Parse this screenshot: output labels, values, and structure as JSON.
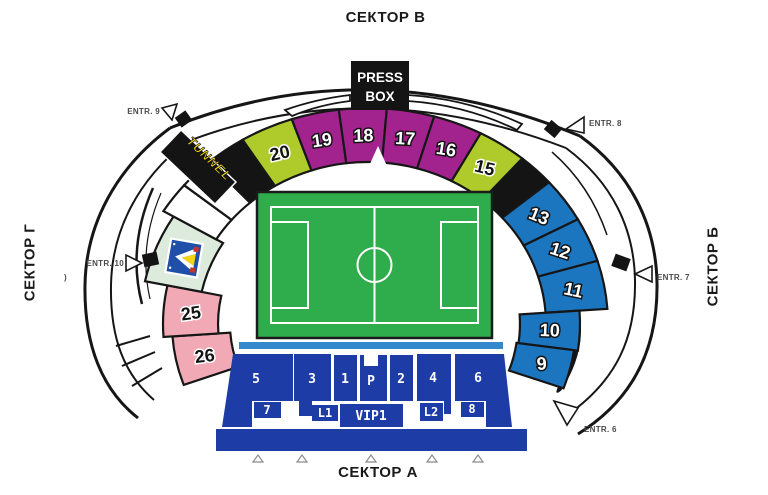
{
  "titles": {
    "top": "СЕКТОР В",
    "bottom": "СЕКТОР А",
    "left": "СЕКТОР Г",
    "right": "СЕКТОР Б"
  },
  "press_box": {
    "line1": "PRESS",
    "line2": "BOX"
  },
  "tunnel": {
    "label": "TUNNEL",
    "text_color": "#F2D516"
  },
  "colors": {
    "magenta": "#A3238E",
    "lime": "#AFCA2B",
    "blue": "#1B76BF",
    "pink": "#F2A9B6",
    "pale_green": "#DCEBDC",
    "black": "#141414",
    "white": "#FFFFFF",
    "dark_blue": "#1E3CA6",
    "light_blue": "#3389CB",
    "field_green": "#2FAC4B",
    "crest_blue": "#1F4FA8",
    "crest_yellow": "#F5D414",
    "crest_red": "#C4332D"
  },
  "arc_sections": [
    {
      "label": "26",
      "color": "pink",
      "a0": 184,
      "a1": 200,
      "radii": [
        138,
        125,
        196,
        178
      ],
      "num": "dark",
      "rot": -7
    },
    {
      "label": "25",
      "color": "pink",
      "a0": 168,
      "a1": 184,
      "radii": [
        150,
        136,
        205,
        186
      ],
      "num": "dark",
      "rot": -8
    },
    {
      "label": "",
      "color": "pale_green",
      "a0": 148.5,
      "a1": 168,
      "radii": [
        170,
        155,
        228,
        206
      ],
      "name": "club-crest-section"
    },
    {
      "label": "",
      "color": "white",
      "a0": 140,
      "a1": 148.5,
      "name": "concourse-segment"
    },
    {
      "label": "",
      "color": "white",
      "a0": 131.5,
      "a1": 140,
      "name": "concourse-segment"
    },
    {
      "label": "",
      "color": "black",
      "a0": 121.5,
      "a1": 131.5,
      "name": "black-section-left"
    },
    {
      "label": "20",
      "color": "lime",
      "a0": 108.5,
      "a1": 121.5,
      "num": "dark",
      "rot": -13
    },
    {
      "label": "19",
      "color": "magenta",
      "a0": 97,
      "a1": 108.5,
      "num": "light",
      "rot": -8
    },
    {
      "label": "18",
      "color": "magenta",
      "a0": 85.5,
      "a1": 97,
      "num": "light",
      "rot": -2
    },
    {
      "label": "17",
      "color": "magenta",
      "a0": 74,
      "a1": 85.5,
      "num": "light",
      "rot": 3
    },
    {
      "label": "16",
      "color": "magenta",
      "a0": 62,
      "a1": 74,
      "num": "light",
      "rot": 9
    },
    {
      "label": "15",
      "color": "lime",
      "a0": 50,
      "a1": 62,
      "num": "dark",
      "rot": 14
    },
    {
      "label": "",
      "color": "black",
      "a0": 41,
      "a1": 50,
      "name": "black-section-right"
    },
    {
      "label": "13",
      "color": "blue",
      "a0": 29,
      "a1": 41,
      "num": "light",
      "rot": 22
    },
    {
      "label": "12",
      "color": "blue",
      "a0": 17,
      "a1": 29,
      "num": "light",
      "rot": 18
    },
    {
      "label": "11",
      "color": "blue",
      "a0": 4,
      "a1": 17,
      "num": "light",
      "rot": 12
    },
    {
      "label": "10",
      "color": "blue",
      "a0": -8,
      "a1": 4,
      "radii": [
        152,
        138,
        212,
        192
      ],
      "num": "light",
      "rot": 2
    },
    {
      "label": "9",
      "color": "blue",
      "a0": -20,
      "a1": -8,
      "radii": [
        150,
        136,
        208,
        188
      ],
      "num": "light",
      "rot": -4
    }
  ],
  "entrances": [
    {
      "label": "ENTR. 9"
    },
    {
      "label": "ENTR. 8"
    },
    {
      "label": "ENTR. 10",
      "suffix": ")"
    },
    {
      "label": "ENTR. 7"
    },
    {
      "label": "ENTR. 6"
    }
  ],
  "stand": {
    "main_labels": [
      "5",
      "3",
      "1",
      "P",
      "2",
      "4",
      "6"
    ],
    "sub_labels": [
      "7",
      "L1",
      "VIP1",
      "L2",
      "8"
    ]
  }
}
